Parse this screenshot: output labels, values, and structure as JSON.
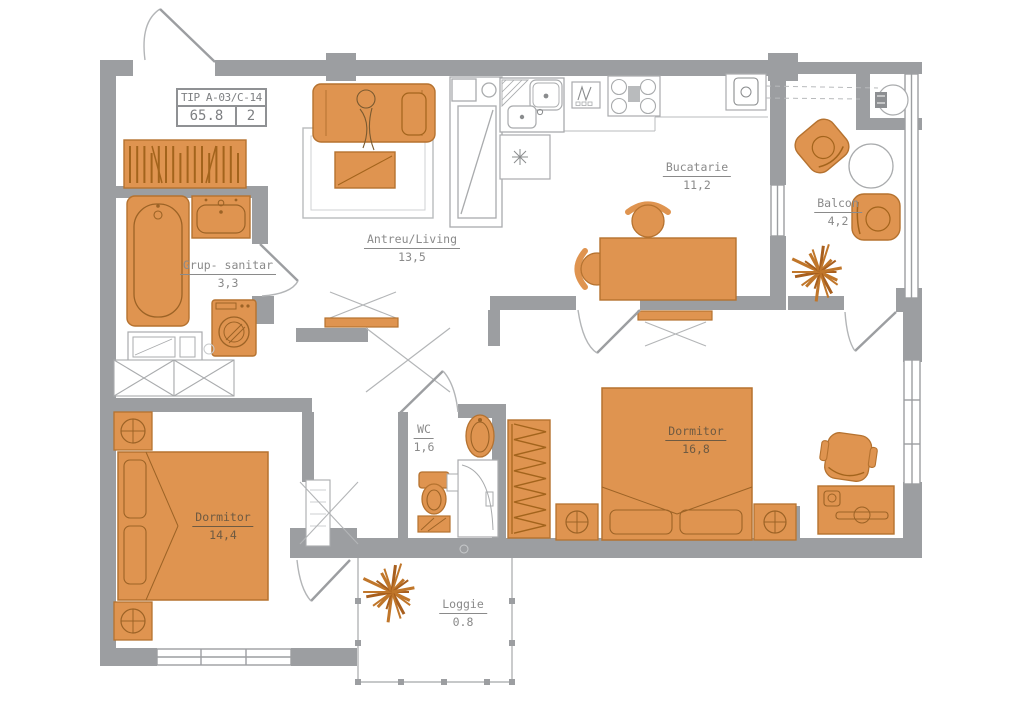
{
  "title_block": {
    "code": "TIP A-03/C-14",
    "area": "65.8",
    "rooms": "2"
  },
  "rooms": [
    {
      "id": "antreu",
      "name": "Antreu/Living",
      "area": "13,5"
    },
    {
      "id": "bucatarie",
      "name": "Bucatarie",
      "area": "11,2"
    },
    {
      "id": "balcon",
      "name": "Balcon",
      "area": "4,2"
    },
    {
      "id": "grup_sanitar",
      "name": "Grup- sanitar",
      "area": "3,3"
    },
    {
      "id": "wc",
      "name": "WC",
      "area": "1,6"
    },
    {
      "id": "dormitor_mare",
      "name": "Dormitor",
      "area": "16,8"
    },
    {
      "id": "dormitor_mic",
      "name": "Dormitor",
      "area": "14,4"
    },
    {
      "id": "loggie",
      "name": "Loggie",
      "area": "0.8"
    }
  ],
  "colors": {
    "wall": "#9c9ea1",
    "outline": "#a9abad",
    "furniture": "#df9450",
    "furniture_stroke": "#b5722f",
    "furniture_detail": "#a3641c",
    "label": "#8a8a8a",
    "label_on_furniture": "#6e5a42",
    "background": "#ffffff"
  },
  "furniture_icons": [
    "sofa-icon",
    "rug-icon",
    "coffee-table-icon",
    "tv-stand-icon",
    "tall-cabinet-icon",
    "kitchen-sink-icon",
    "extractor-cabinet-icon",
    "dishwasher-icon",
    "stove-icon",
    "boiler-icon",
    "dining-table-icon",
    "chair-icon",
    "armchair-icon",
    "round-table-icon",
    "plant-icon",
    "towel-radiator-icon",
    "bathtub-icon",
    "washbasin-icon",
    "washing-machine-icon",
    "vanity-icon",
    "toilet-icon",
    "shower-cabin-icon",
    "double-bed-icon",
    "nightstand-lamp-icon",
    "wardrobe-icon",
    "desk-icon",
    "office-chair-icon",
    "utility-fixture-icon"
  ]
}
